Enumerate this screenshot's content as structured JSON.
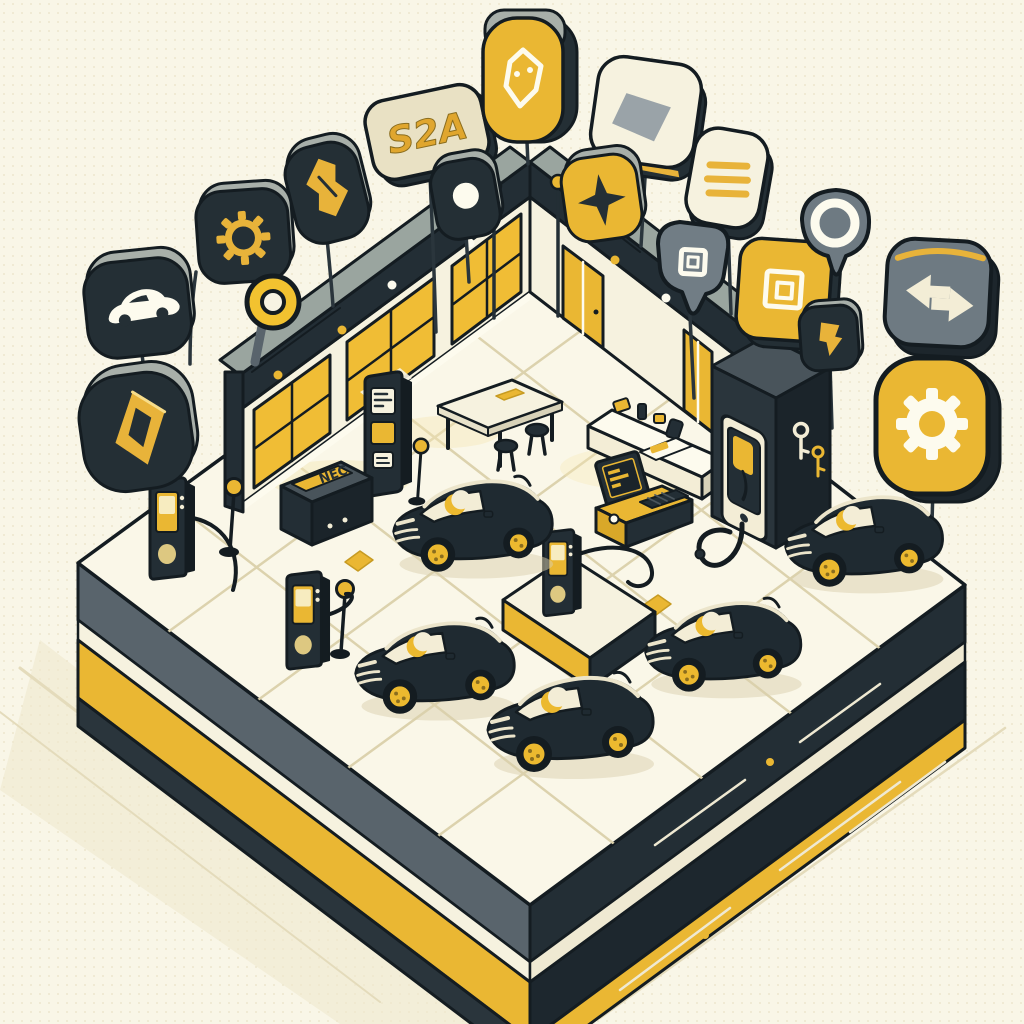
{
  "scene": {
    "description": "Isometric illustration of an electric-vehicle dealership and charging hub on a floating platform surrounded by floating feature badges",
    "sign_text": "S2A",
    "cabinet_label": "NEC",
    "counts": {
      "cars": 5,
      "charging_towers": 3,
      "wall_chargers": 1,
      "lollipop_lamps": 4,
      "floating_badges": 17
    }
  },
  "colors": {
    "background": "#f9f6e7",
    "accent_yellow": "#eab733",
    "bright_yellow": "#f2c230",
    "charcoal": "#232e35",
    "ink": "#141c21",
    "slate_gray": "#59646c",
    "light_gray": "#a8afa9",
    "cream": "#f6f2df",
    "tan_line": "#dcd2ad"
  },
  "badges": [
    {
      "name": "car-badge",
      "icon": "car-icon",
      "style": "dark"
    },
    {
      "name": "gear-badge-dark",
      "icon": "gear-icon",
      "style": "dark"
    },
    {
      "name": "brand-diamond-badge",
      "icon": "diamond-icon",
      "style": "dark"
    },
    {
      "name": "ring-lollipop",
      "icon": "ring-icon",
      "style": "yellow"
    },
    {
      "name": "ticket-badge",
      "icon": "ticket-icon",
      "style": "dark"
    },
    {
      "name": "s2a-sign",
      "icon": "text-sign",
      "label": "S2A",
      "style": "cream"
    },
    {
      "name": "gem-badge",
      "icon": "gem-icon",
      "style": "yellow"
    },
    {
      "name": "record-badge",
      "icon": "circle-icon",
      "style": "dark"
    },
    {
      "name": "card-sign",
      "icon": "card-icon",
      "style": "white"
    },
    {
      "name": "sparkle-badge",
      "icon": "sparkle-icon",
      "style": "yellow"
    },
    {
      "name": "list-badge",
      "icon": "list-icon",
      "style": "white"
    },
    {
      "name": "funnel-badge",
      "icon": "square-icon",
      "style": "gray"
    },
    {
      "name": "square-badge-yellow",
      "icon": "nested-square-icon",
      "style": "yellow"
    },
    {
      "name": "ring-badge-gray",
      "icon": "ring-icon",
      "style": "gray"
    },
    {
      "name": "flag-badge",
      "icon": "flag-icon",
      "style": "dark"
    },
    {
      "name": "swap-badge",
      "icon": "swap-arrows-icon",
      "style": "gray"
    },
    {
      "name": "gear-badge-yellow",
      "icon": "gear-icon",
      "style": "yellow"
    }
  ]
}
